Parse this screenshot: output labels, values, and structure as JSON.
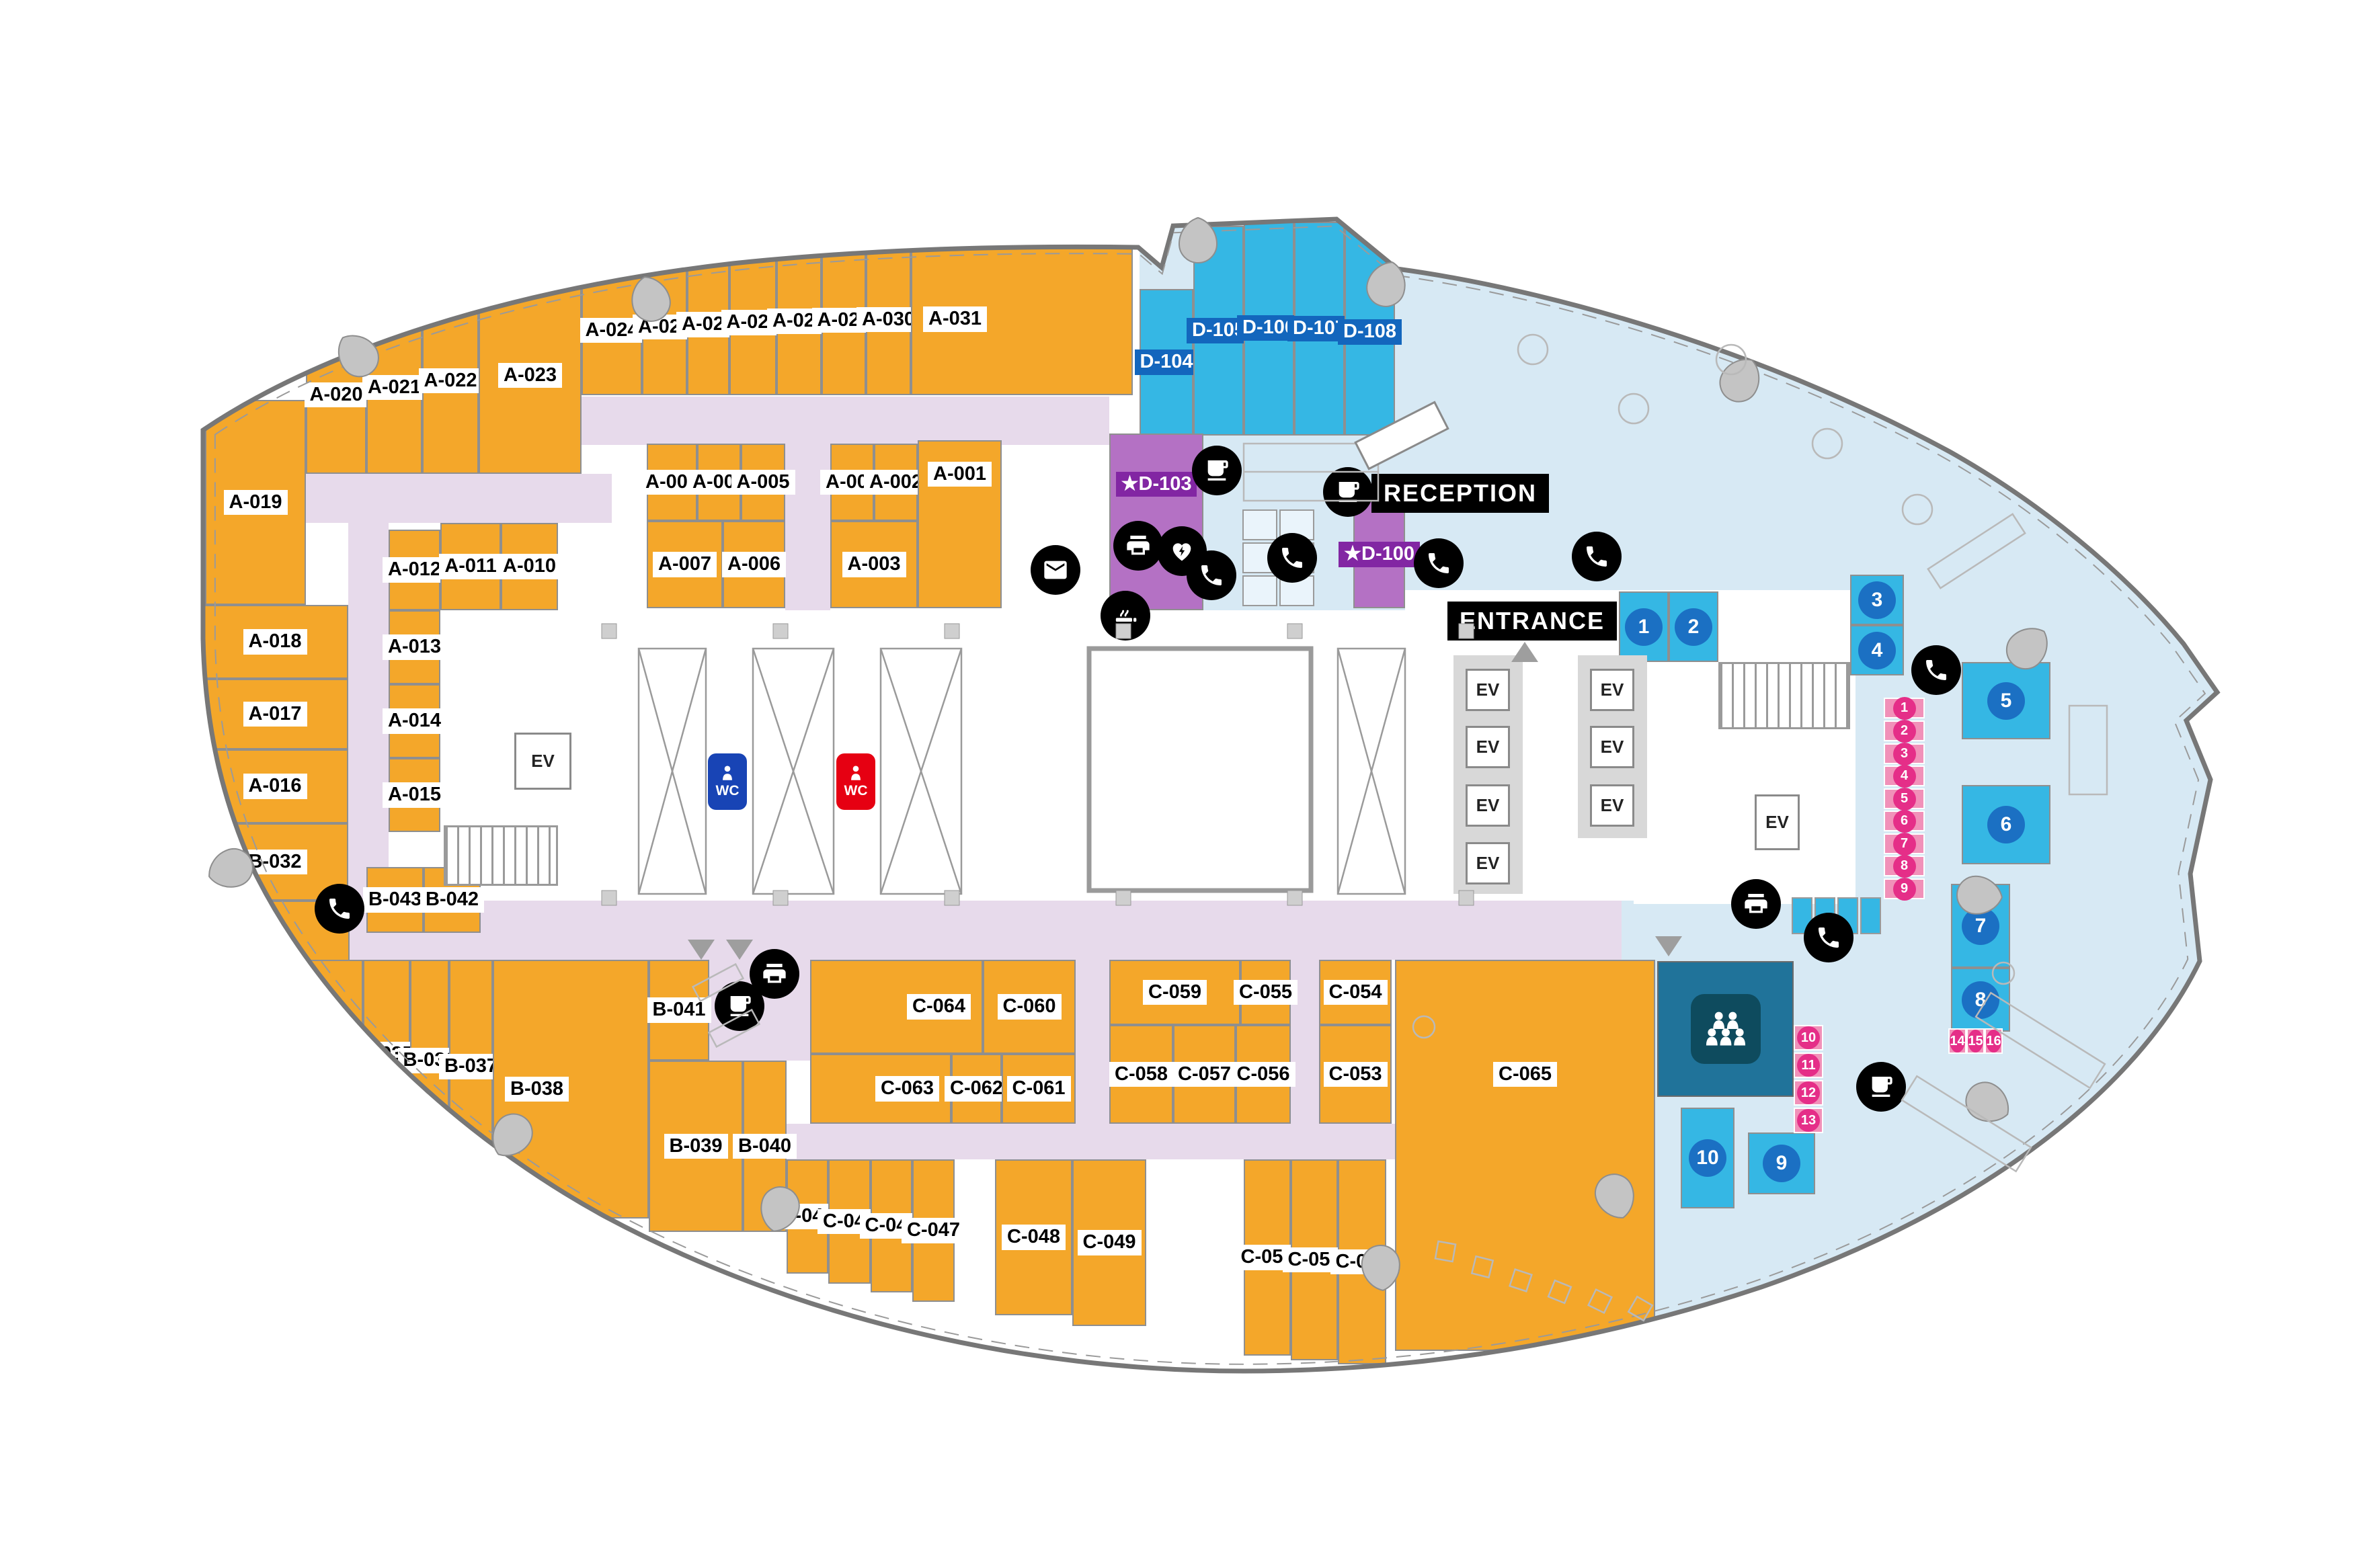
{
  "fp": {
    "labels": {
      "entrance": "ENTRANCE",
      "reception": "RECEPTION",
      "ev": "EV",
      "wc": "WC"
    },
    "a": [
      "A-001",
      "A-002",
      "A-003",
      "A-004",
      "A-005",
      "A-006",
      "A-007",
      "A-008",
      "A-009",
      "A-010",
      "A-011",
      "A-012",
      "A-013",
      "A-014",
      "A-015",
      "A-016",
      "A-017",
      "A-018",
      "A-019",
      "A-020",
      "A-021",
      "A-022",
      "A-023",
      "A-024",
      "A-025",
      "A-026",
      "A-027",
      "A-028",
      "A-029",
      "A-030",
      "A-031"
    ],
    "b": [
      "B-032",
      "B-033",
      "B-034",
      "B-035",
      "B-036",
      "B-037",
      "B-038",
      "B-039",
      "B-040",
      "B-041",
      "B-042",
      "B-043"
    ],
    "c": [
      "C-044",
      "C-045",
      "C-046",
      "C-047",
      "C-048",
      "C-049",
      "C-050",
      "C-051",
      "C-052",
      "C-053",
      "C-054",
      "C-055",
      "C-056",
      "C-057",
      "C-058",
      "C-059",
      "C-060",
      "C-061",
      "C-062",
      "C-063",
      "C-064",
      "C-065"
    ],
    "d": [
      "D-104",
      "D-105",
      "D-106",
      "D-107",
      "D-108"
    ],
    "premium": [
      "★D-100",
      "★D-103"
    ],
    "mtg": [
      "1",
      "2",
      "3",
      "4",
      "5",
      "6",
      "7",
      "8",
      "9",
      "10"
    ],
    "booth": [
      "1",
      "2",
      "3",
      "4",
      "5",
      "6",
      "7",
      "8",
      "9",
      "10",
      "11",
      "12",
      "13",
      "14",
      "15",
      "16"
    ],
    "icons": [
      "phone-icon",
      "coffee-icon",
      "printer-icon",
      "mail-icon",
      "aed-icon",
      "smoking-icon",
      "wc-male-icon",
      "wc-female-icon",
      "meeting-people-icon",
      "elevator-label",
      "stairs"
    ],
    "colors": {
      "office_orange": "#F4A72A",
      "meeting_cyan": "#35B7E4",
      "meeting_label_blue": "#1366BD",
      "lounge_blue": "#D7E9F4",
      "corridor_lavender": "#E7DAEB",
      "phone_booth_pink": "#F191B9",
      "booth_badge_pink": "#E52E88",
      "premium_purple": "#B471C4",
      "premium_label_purple": "#8226A3",
      "seminar_teal": "#20739A",
      "number_circle_blue": "#1B70C3",
      "wc_blue": "#1844B5",
      "wc_red": "#E60012",
      "icon_black": "#000000",
      "wall_gray": "#8f8f8f"
    }
  }
}
